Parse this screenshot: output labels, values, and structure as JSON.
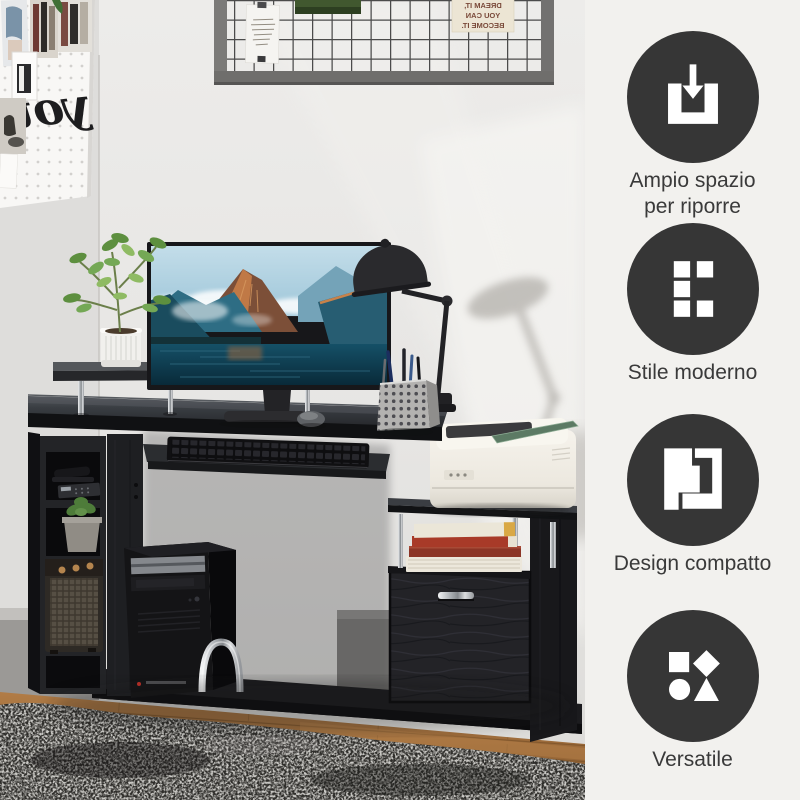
{
  "sidebar": {
    "features": [
      {
        "label": "Ampio spazio per riporre",
        "icon": "storage-inbox-icon"
      },
      {
        "label": "Stile moderno",
        "icon": "modern-grid-icon"
      },
      {
        "label": "Design compatto",
        "icon": "compact-design-icon"
      },
      {
        "label": "Versatile",
        "icon": "versatile-shapes-icon"
      }
    ]
  },
  "photo": {
    "pegboard_word": "you",
    "memo_quote_lines": [
      "IF YOU CAN",
      "DREAM IT,",
      "YOU CAN",
      "BECOME IT."
    ]
  },
  "colors": {
    "badge_circle": "#363636",
    "icon_glyph": "#ffffff",
    "sidebar_bg": "#f2f1ee",
    "label_text": "#3a3a3a",
    "desk_black": "#1b1b1d",
    "rug_dark": "#2f2e2b",
    "wood_floor": "#a5753f"
  }
}
